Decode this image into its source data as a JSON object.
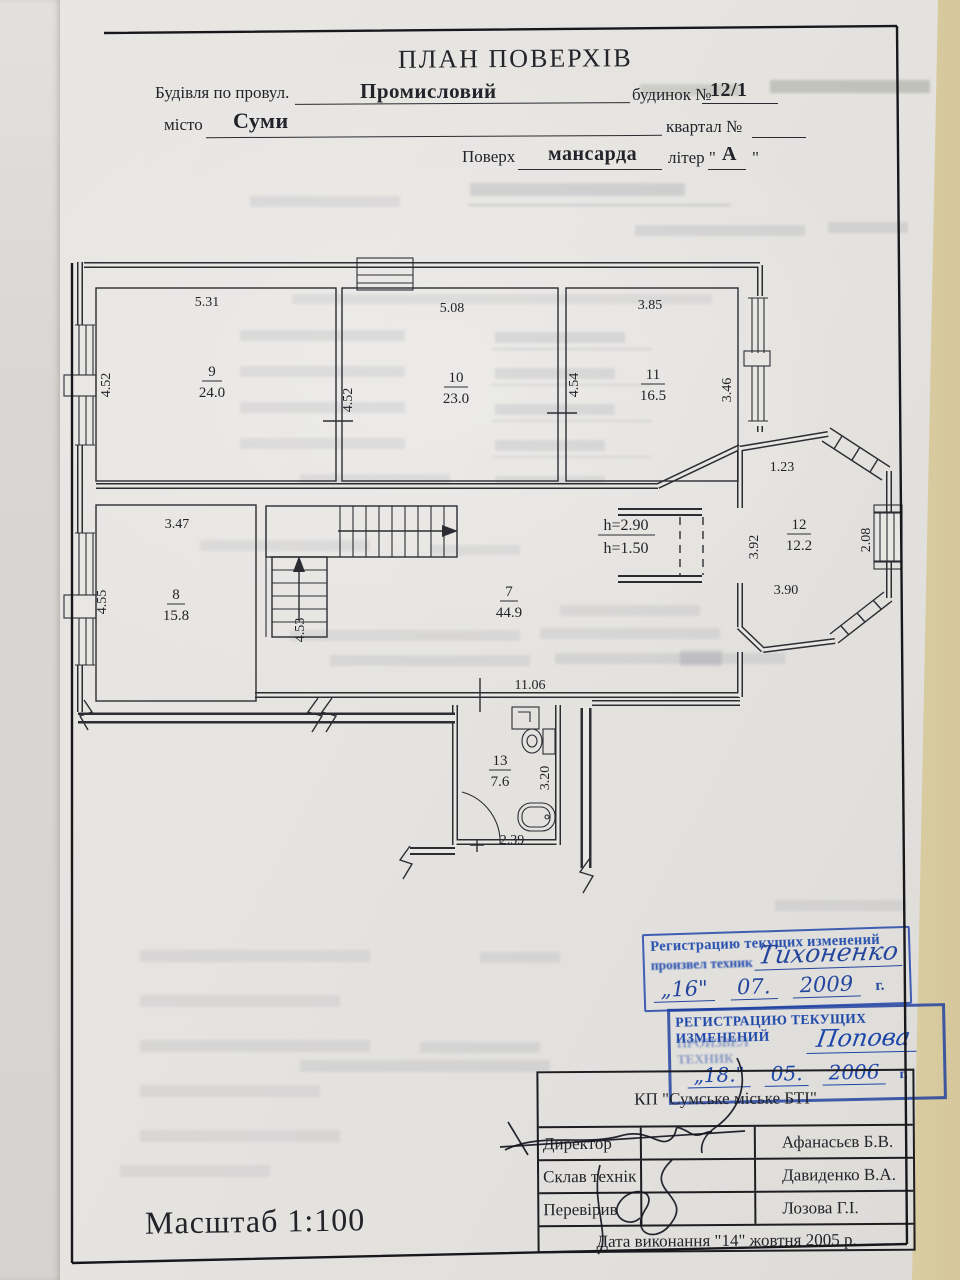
{
  "header": {
    "title": "ПЛАН ПОВЕРХІВ",
    "building_label": "Будівля по провул.",
    "building_value": "Промисловий",
    "house_label": "будинок №",
    "house_value": "12/1",
    "city_label": "місто",
    "city_value": "Суми",
    "quarter_label": "квартал №",
    "floor_label": "Поверх",
    "floor_value": "мансарда",
    "letter_prefix": "літер \"",
    "letter_value": "А",
    "letter_suffix": "\""
  },
  "plan": {
    "room7": {
      "num": "7",
      "area": "44.9"
    },
    "room8": {
      "num": "8",
      "area": "15.8",
      "dim_top": "3.47",
      "dim_left": "4.55",
      "dim_right": "4.53"
    },
    "room9": {
      "num": "9",
      "area": "24.0",
      "dim_top": "5.31",
      "dim_left": "4.52"
    },
    "room10": {
      "num": "10",
      "area": "23.0",
      "dim_top": "5.08",
      "dim_left": "4.52"
    },
    "room11": {
      "num": "11",
      "area": "16.5",
      "dim_top": "3.85",
      "dim_left": "4.54",
      "dim_right": "3.46"
    },
    "room12": {
      "num": "12",
      "area": "12.2",
      "dim_top": "1.23",
      "dim_left": "3.92",
      "dim_right": "2.08",
      "dim_bottom": "3.90"
    },
    "room13": {
      "num": "13",
      "area": "7.6",
      "dim_right": "3.20",
      "dim_bottom": "2.39"
    },
    "height1": "h=2.90",
    "height2": "h=1.50",
    "dim_bottom": "11.06"
  },
  "stamps": {
    "stamp1": {
      "line1": "Регистрацию текущих изменений",
      "line2": "произвел техник",
      "name": "Тихоненко",
      "day": "„16\"",
      "month": "07.",
      "year": "2009",
      "suffix": "г."
    },
    "stamp2": {
      "line1": "РЕГИСТРАЦИЮ ТЕКУЩИХ ИЗМЕНЕНИЙ",
      "line2": "ПРОИЗВЕЛ ТЕХНИК",
      "name": "Попова",
      "day": "„18.\"",
      "month": "05.",
      "year": "2006",
      "suffix": "г."
    }
  },
  "title_block": {
    "org": "КП \"Сумське міське БТІ\"",
    "rows": [
      {
        "role": "Директор",
        "name": "Афанасьєв Б.В."
      },
      {
        "role": "Склав технік",
        "name": "Давиденко В.А."
      },
      {
        "role": "Перевірив",
        "name": "Лозова Г.І."
      }
    ],
    "date_line": "Дата виконання \"14\" жовтня 2005 р."
  },
  "footer": {
    "scale": "Масштаб 1:100"
  }
}
